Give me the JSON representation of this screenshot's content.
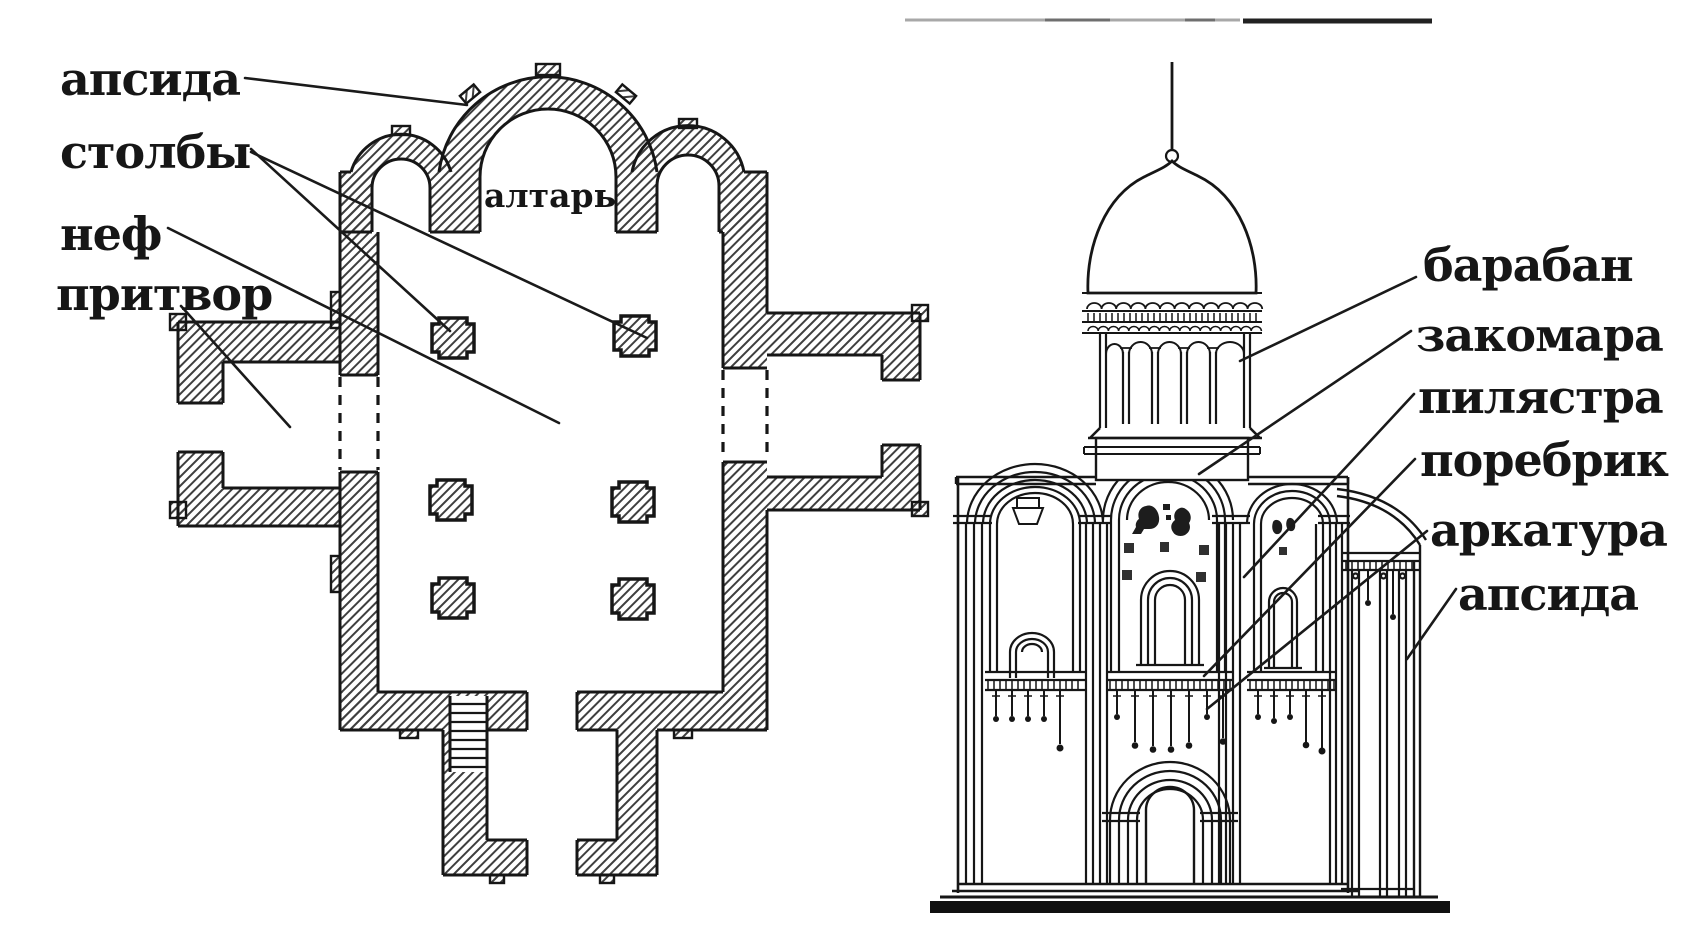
{
  "figure_type": "architecture-diagram",
  "subject": "Russian medieval church: floor plan and facade elevation with labeled parts",
  "colors": {
    "background": "#ffffff",
    "ink": "#161616",
    "hatch": "#3f3f3f"
  },
  "plan": {
    "interior_label": "алтарь",
    "labels": {
      "apse": "апсида",
      "pillars": "столбы",
      "nave": "неф",
      "narthex": "притвор"
    }
  },
  "elevation": {
    "labels": {
      "drum": "барабан",
      "zakomara": "закомара",
      "pilaster": "пилястра",
      "porebrik": "поребрик",
      "arcature": "аркатура",
      "apse": "апсида"
    }
  }
}
